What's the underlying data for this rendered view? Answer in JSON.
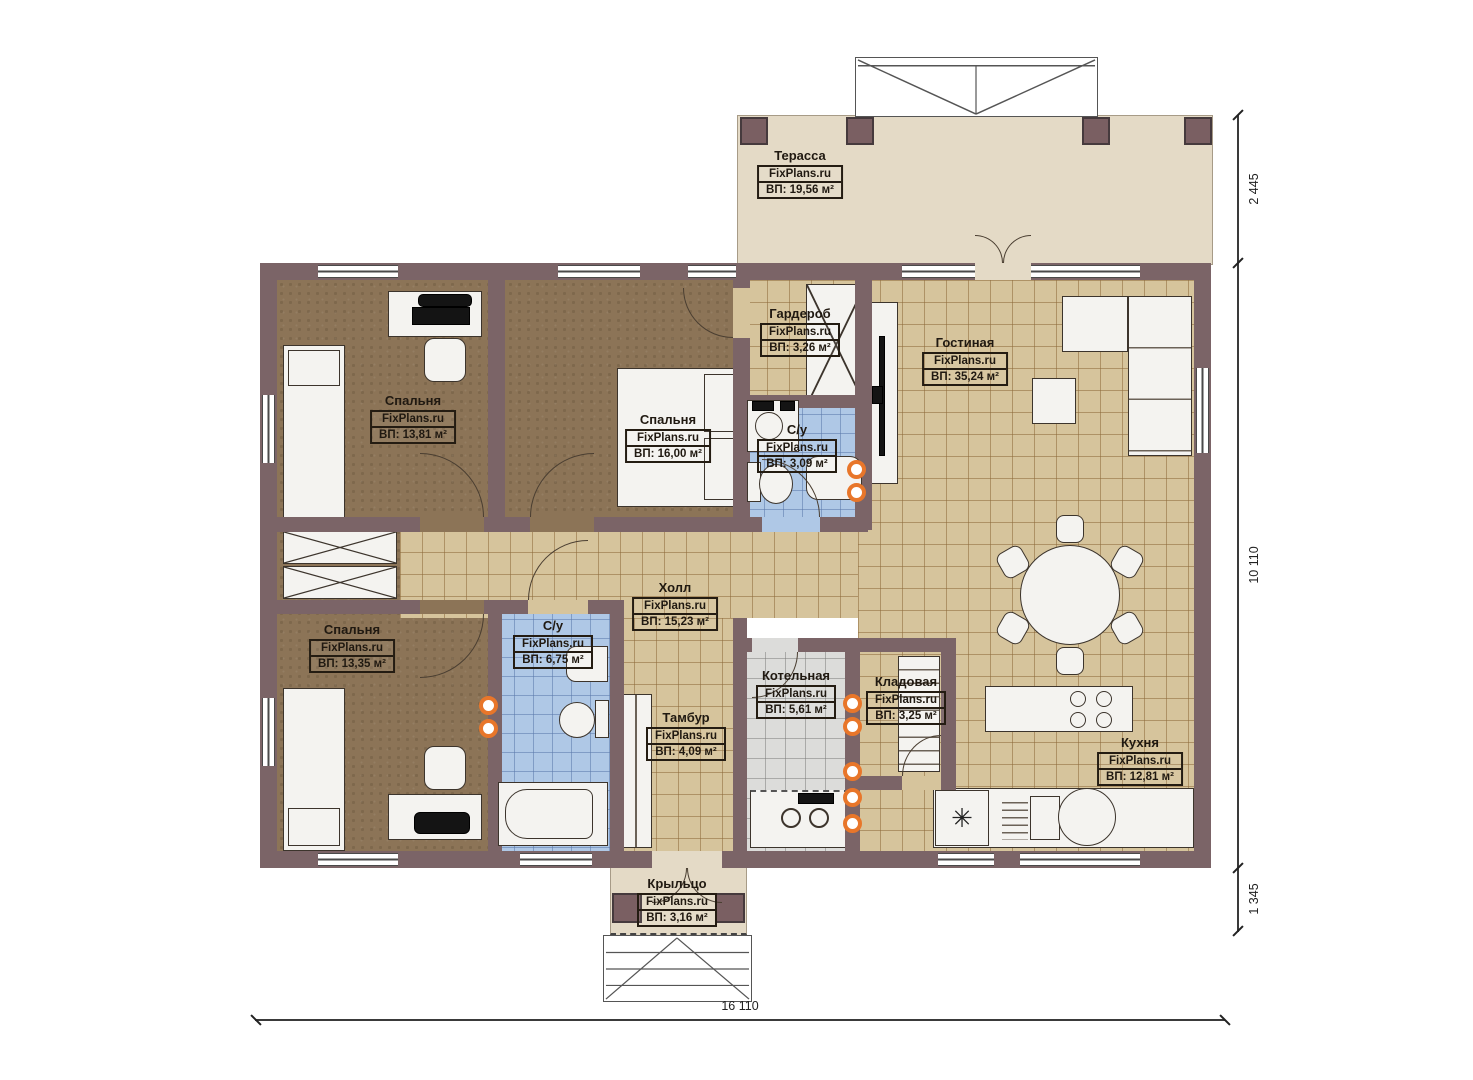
{
  "brand": "FixPlans.ru",
  "rooms": {
    "terrace": {
      "name": "Терасса",
      "area": "ВП: 19,56 м²"
    },
    "bedroom1": {
      "name": "Спальня",
      "area": "ВП: 13,81 м²"
    },
    "bedroom2": {
      "name": "Спальня",
      "area": "ВП: 16,00 м²"
    },
    "wardrobe": {
      "name": "Гардероб",
      "area": "ВП: 3,26 м²"
    },
    "bath1": {
      "name": "С/у",
      "area": "ВП: 3,09 м²"
    },
    "living": {
      "name": "Гостиная",
      "area": "ВП: 35,24 м²"
    },
    "hall": {
      "name": "Холл",
      "area": "ВП: 15,23 м²"
    },
    "bedroom3": {
      "name": "Спальня",
      "area": "ВП: 13,35 м²"
    },
    "bath2": {
      "name": "С/у",
      "area": "ВП: 6,75 м²"
    },
    "tambour": {
      "name": "Тамбур",
      "area": "ВП: 4,09 м²"
    },
    "boiler": {
      "name": "Котельная",
      "area": "ВП: 5,61 м²"
    },
    "storage": {
      "name": "Кладовая",
      "area": "ВП: 3,25 м²"
    },
    "kitchen": {
      "name": "Кухня",
      "area": "ВП: 12,81 м²"
    },
    "porch": {
      "name": "Крыльцо",
      "area": "ВП: 3,16 м²"
    }
  },
  "dimensions": {
    "right_top": "2 445",
    "right_middle": "10 110",
    "right_bottom": "1 345",
    "bottom": "16 110"
  },
  "icons": {
    "fridge": "✳"
  },
  "colors": {
    "wall": "#7b6467",
    "tan": "#d6c49c",
    "blue": "#afc8e6",
    "brown": "#8c7457",
    "gray": "#dcdcda",
    "terrace": "#e4dac6",
    "accent": "#e8762a"
  }
}
